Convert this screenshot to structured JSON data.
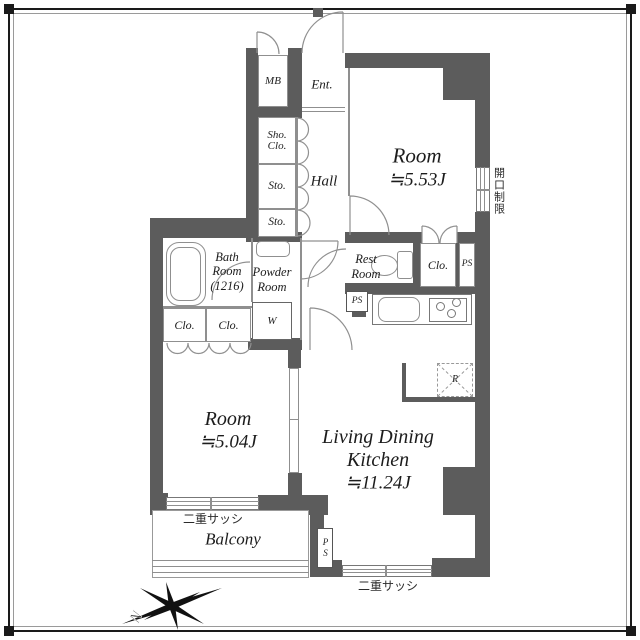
{
  "colors": {
    "wall": "#5c5c5c",
    "thin_line": "#8f8f8f",
    "text": "#1c1c1c"
  },
  "plan": {
    "entrance": {
      "mb": "MB",
      "label": "Ent."
    },
    "hall": {
      "label": "Hall",
      "shoes_closet_line1": "Sho.",
      "shoes_closet_line2": "Clo.",
      "storage_upper": "Sto.",
      "storage_lower": "Sto."
    },
    "bedroom_upper": {
      "name": "Room",
      "size": "≒5.53J",
      "closet": "Clo.",
      "ps": "PS",
      "opening_restriction": "開口制限"
    },
    "sanitary": {
      "bath_line1": "Bath",
      "bath_line2": "Room",
      "bath_line3": "(1216)",
      "powder_line1": "Powder",
      "powder_line2": "Room",
      "washer": "W",
      "closet_left": "Clo.",
      "closet_right": "Clo.",
      "toilet_line1": "Rest",
      "toilet_line2": "Room",
      "ps": "PS"
    },
    "ldk": {
      "name_line1": "Living Dining",
      "name_line2": "Kitchen",
      "size": "≒11.24J",
      "fridge": "R"
    },
    "bedroom_lower": {
      "name": "Room",
      "size": "≒5.04J"
    },
    "balcony": {
      "label": "Balcony",
      "double_sash_bedroom": "二重サッシ",
      "double_sash_ldk": "二重サッシ",
      "ps": "PS"
    },
    "compass": {
      "north": "N"
    }
  }
}
